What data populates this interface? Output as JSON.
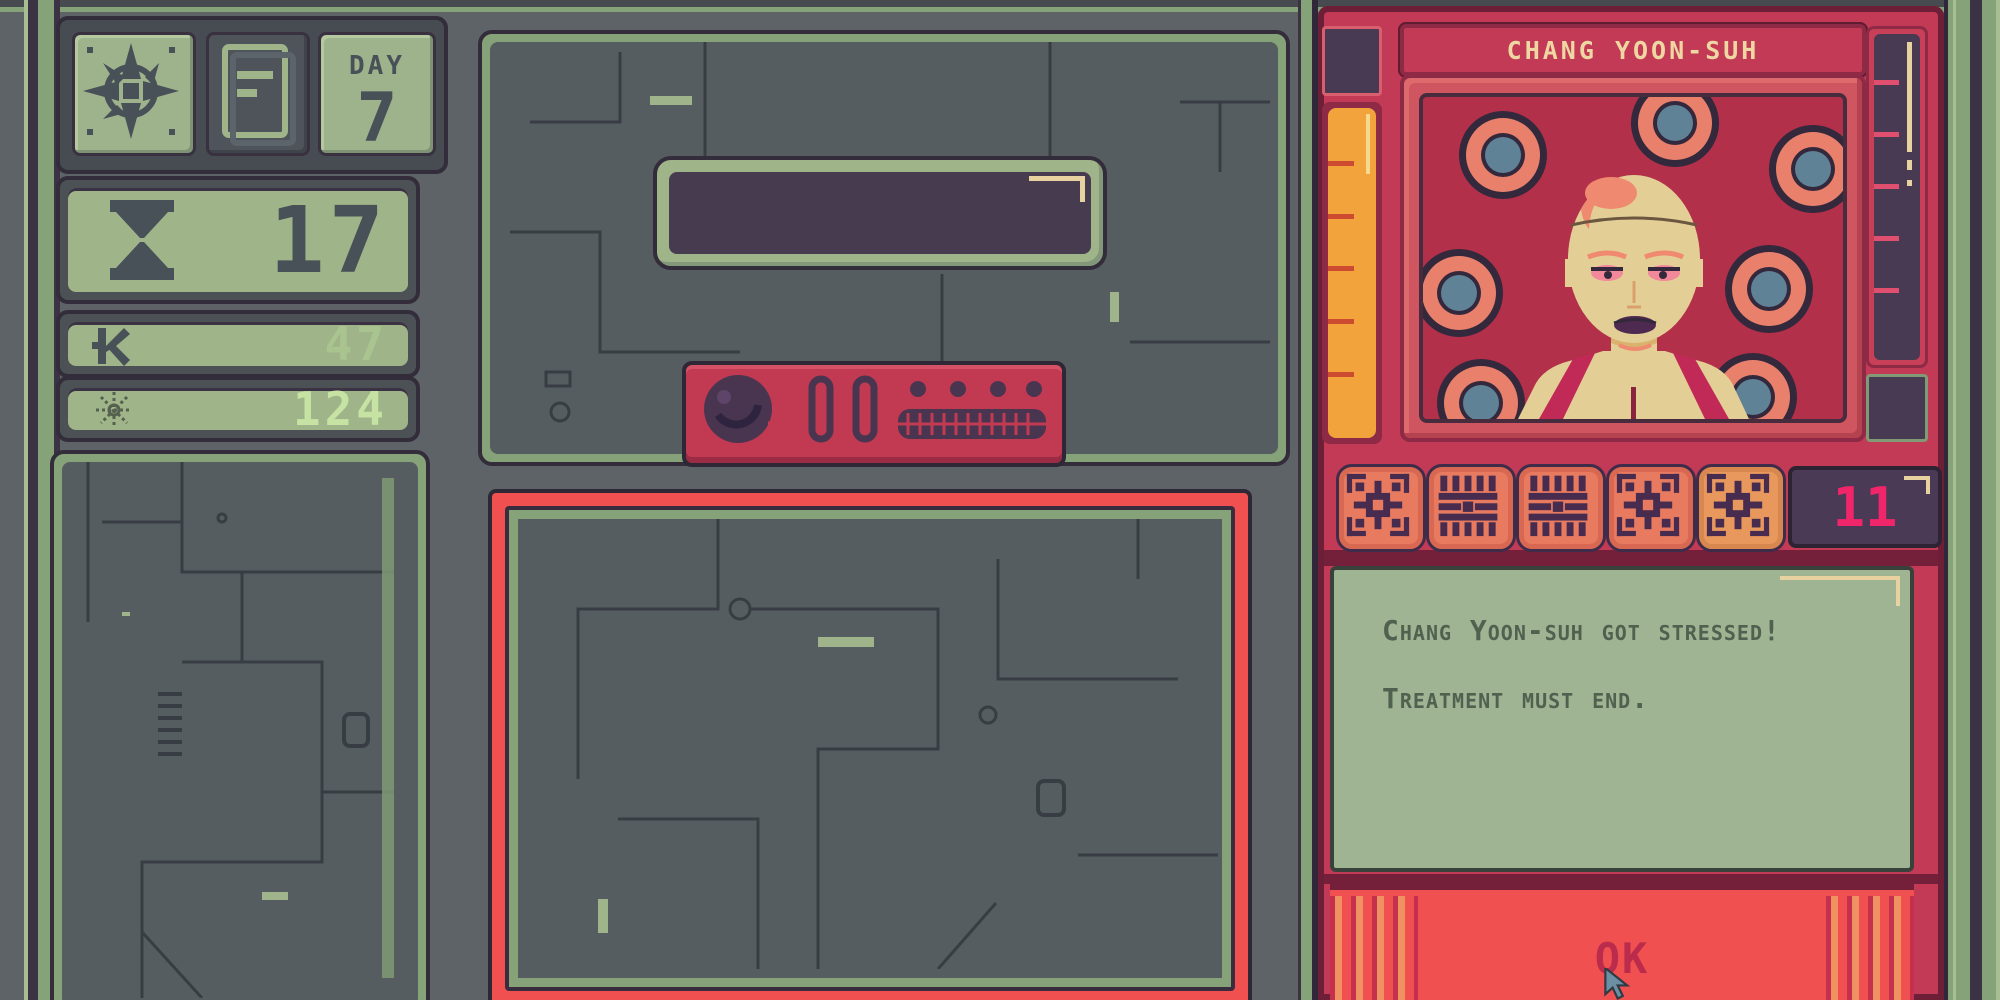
{
  "app": {
    "name": "patient treatment console"
  },
  "hud": {
    "day": {
      "label": "DAY",
      "value": "7"
    },
    "hourglass": {
      "value": "17"
    },
    "currency": {
      "value": "47"
    },
    "sun": {
      "value": "124"
    }
  },
  "patient": {
    "name": "CHANG YOON-SUH",
    "seal_count": "11",
    "message": {
      "line1": "Chang Yoon-suh got stressed!",
      "line2": "Treatment must end."
    },
    "ok_label": "OK"
  },
  "icons": {
    "compass": "8-point compass rose",
    "document": "paper sheet with lines",
    "hourglass": "hourglass timer",
    "currency": "kip K money symbol",
    "sun": "sun burst",
    "knob": "round dial knob",
    "seals": [
      "seal-grid",
      "seal-comb",
      "seal-comb",
      "seal-grid",
      "seal-grid-orange"
    ],
    "cursor": "pointer arrow"
  },
  "colors": {
    "machine_gray": "#565d60",
    "frame_green": "#86a279",
    "panel_green": "#9fb489",
    "sage_green": "#9fb493",
    "outline_purple": "#332c3b",
    "screen_purple": "#473a52",
    "slate": "#485058",
    "crimson": "#c23a55",
    "maroon": "#75203a",
    "coral": "#f0504f",
    "salmon": "#e8806c",
    "orange_gauge": "#f2a33c",
    "cream": "#ecd6a4",
    "pink_magenta": "#f12569",
    "blue_gray": "#5f8296",
    "value_green": "#a9c48f",
    "value_mint": "#c6e3a4"
  }
}
